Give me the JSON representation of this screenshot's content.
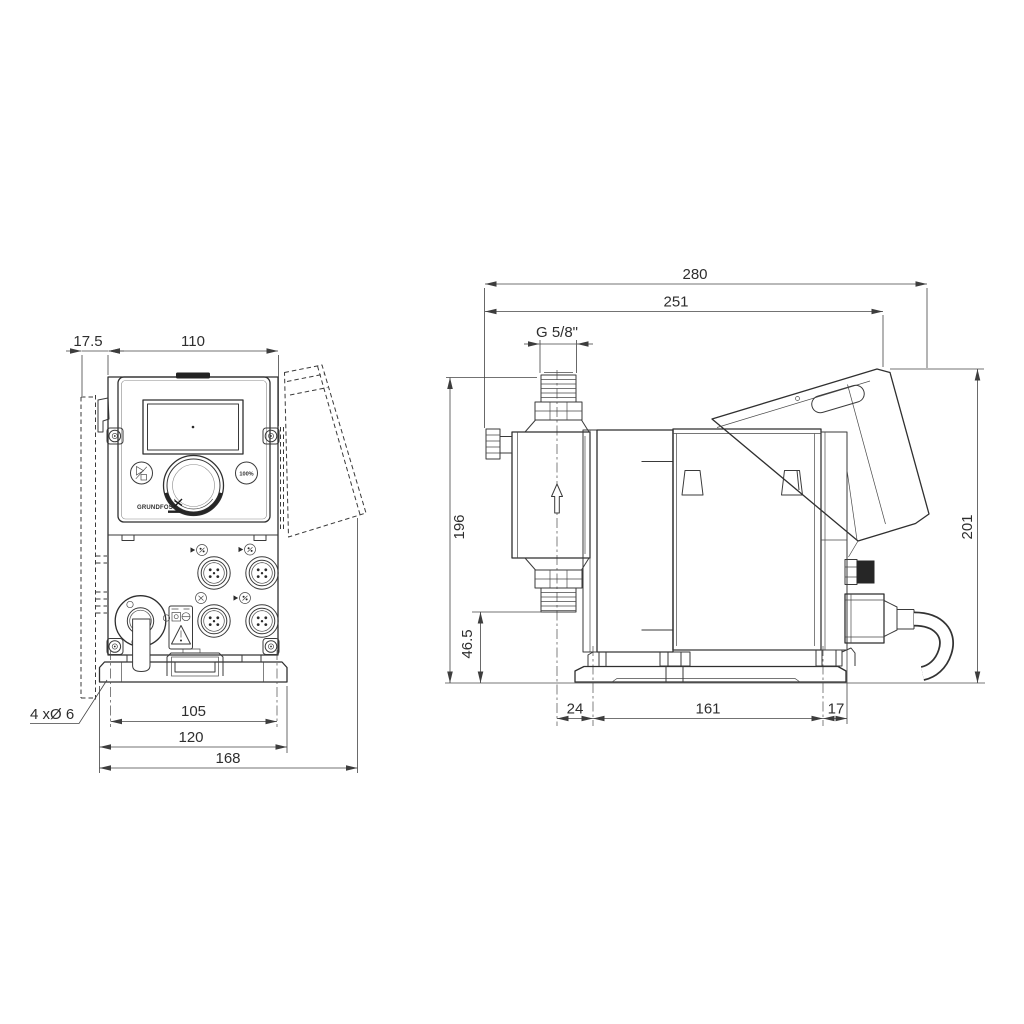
{
  "title": "Dosing pump dimensional drawing, front and side views",
  "front_view": {
    "dimensions": {
      "wall_offset": "17.5",
      "body_width": "110",
      "hole_spacing_h": "105",
      "plate_width": "120",
      "overall_width": "168",
      "mounting_holes": "4 xØ 6"
    },
    "panel": {
      "percent_label": "100%",
      "brand_label": "GRUNDFOS"
    }
  },
  "side_view": {
    "dimensions": {
      "overall_depth": "280",
      "depth_to_cover": "251",
      "connection_thread": "G 5/8\"",
      "height_to_connection": "196",
      "connection_height": "46.5",
      "front_to_first_hole": "24",
      "hole_spacing": "161",
      "last_hole_to_rear": "17",
      "overall_height": "201"
    }
  },
  "colors": {
    "line": "#3a3a3a",
    "dark_fill": "#222222",
    "background": "#ffffff"
  }
}
